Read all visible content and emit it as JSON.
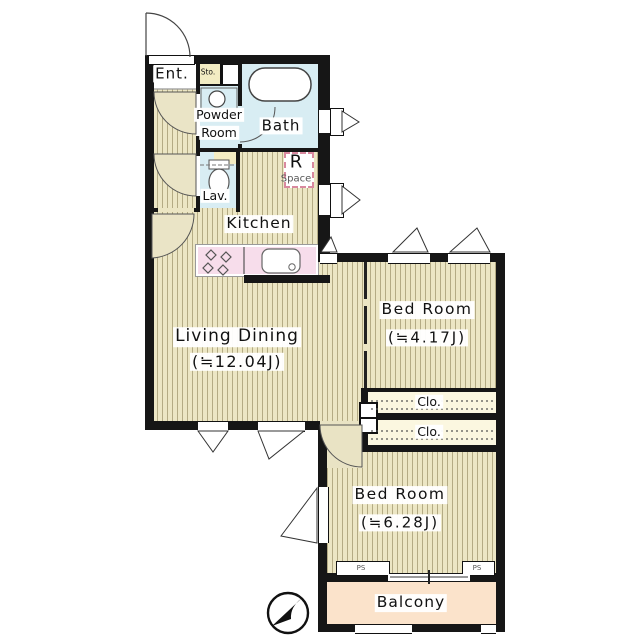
{
  "floorplan": {
    "compass_icon": "north-arrow",
    "rooms": {
      "entrance": {
        "label": "Ent."
      },
      "storage": {
        "label": "Sto."
      },
      "powder_room": {
        "label_line1": "Powder",
        "label_line2": "Room"
      },
      "bath": {
        "label": "Bath"
      },
      "lavatory": {
        "label": "Lav."
      },
      "r_space": {
        "label_line1": "R",
        "label_line2": "Space"
      },
      "kitchen": {
        "label": "Kitchen"
      },
      "living_dining": {
        "label": "Living Dining",
        "size": "(≒12.04J)"
      },
      "bedroom_1": {
        "label": "Bed Room",
        "size": "(≒4.17J)"
      },
      "closet_1": {
        "label": "Clo."
      },
      "closet_2": {
        "label": "Clo."
      },
      "bedroom_2": {
        "label": "Bed Room",
        "size": "(≒6.28J)"
      },
      "balcony": {
        "label": "Balcony"
      },
      "pipe_space_1": {
        "label": "PS"
      },
      "pipe_space_2": {
        "label": "PS"
      }
    },
    "colors": {
      "wall": "#161616",
      "floor_base": "#ece6c4",
      "floor_stripe": "#b4ab84",
      "wet_area": "#d8edf3",
      "kitchen_counter": "#f7ddeb",
      "closet": "#fbf7e0",
      "balcony": "#fbe3cb",
      "storage": "#f3ecc3",
      "r_space_border": "#d9899f"
    }
  }
}
